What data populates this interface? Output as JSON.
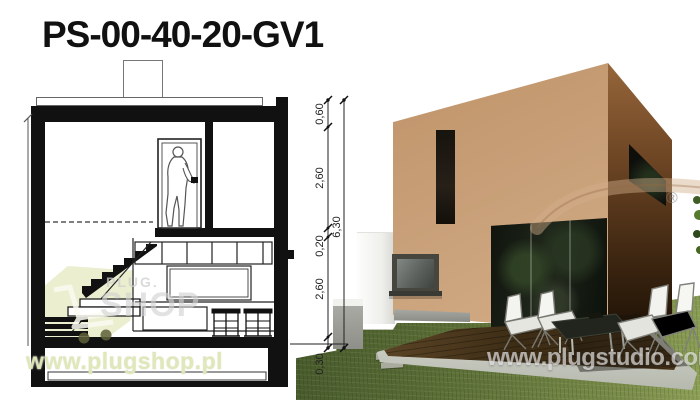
{
  "title": "PS-00-40-20-GV1",
  "section_drawing": {
    "dimensions": {
      "segments": [
        "0,60",
        "2,60",
        "0,20",
        "2,60",
        "0,30"
      ],
      "total": "6,30"
    },
    "features": [
      "chimney",
      "roof-slab",
      "upper-floor-door-with-person",
      "stairs",
      "kitchen-cabinets",
      "bar-table-with-stools",
      "foundation"
    ]
  },
  "render": {
    "features": [
      "cube-house",
      "vertical-slit-window",
      "small-window",
      "glass-sliding-doors",
      "side-band-window",
      "wood-deck-terrace",
      "lounge-chairs",
      "glass-coffee-table",
      "garden-walls",
      "stepping-stones",
      "lawn"
    ]
  },
  "watermarks": {
    "plug_logo_top": "PLUG.",
    "plug_logo_main": "SHOP",
    "shop_url": "www.plugshop.pl",
    "studio_url": "www.plugstudio.com",
    "registered": "®",
    "cart_icon": "shopping-cart-icon"
  },
  "colors": {
    "facade_tan": "#c9a17a",
    "facade_shadow_brown": "#6e4624",
    "grass_green": "#5f7239",
    "deck_wood": "#4a3520",
    "concrete_gray": "#c2c5ba",
    "watermark_pale_green": "#dee7b6",
    "drawing_ink": "#111111"
  }
}
